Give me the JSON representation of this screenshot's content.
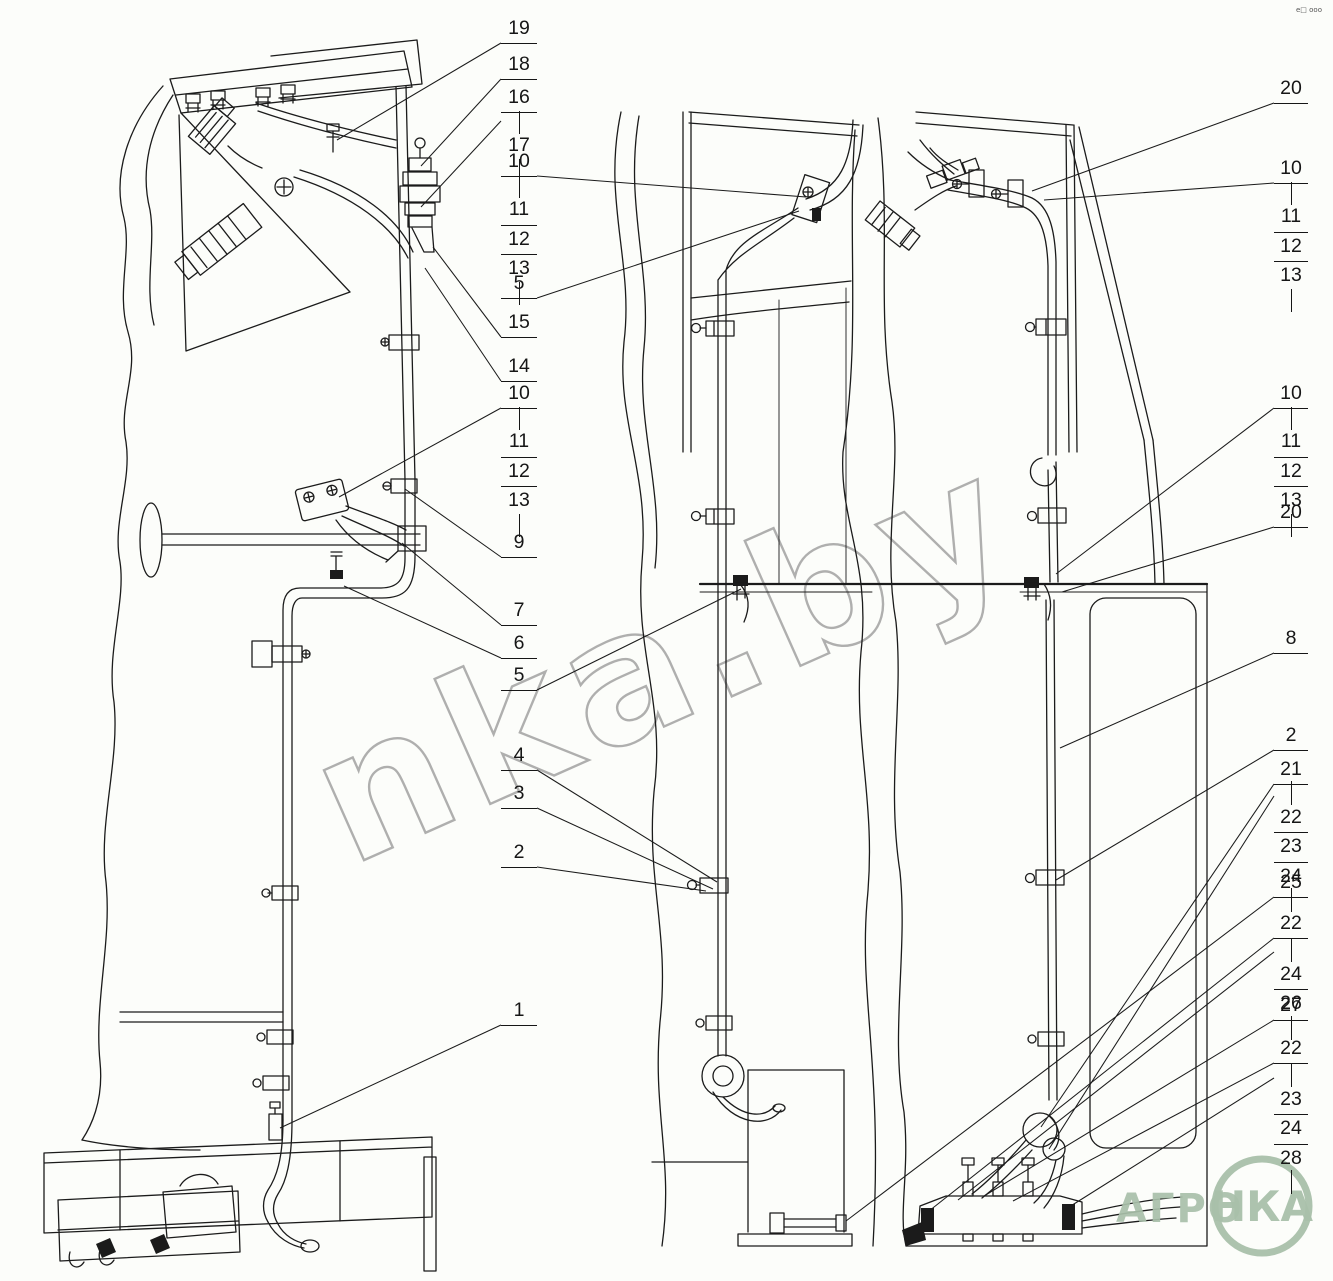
{
  "colors": {
    "line": "#1b1b1b",
    "background": "#fcfdfa",
    "watermark_gray": "#9c9c9c",
    "logo_green": "#a9c0aa"
  },
  "watermark": {
    "text": "nka.by"
  },
  "logo": {
    "prefix": "АГРО",
    "circle_text": "НКА"
  },
  "corner_marks": "e□ ooo",
  "callouts": {
    "left": [
      {
        "label": "19"
      },
      {
        "label": "18"
      },
      {
        "label": "16"
      },
      {
        "label": "17"
      },
      {
        "label": "10",
        "rows": [
          "11",
          "12",
          "13"
        ]
      },
      {
        "label": "5"
      },
      {
        "label": "15"
      },
      {
        "label": "14"
      },
      {
        "label": "10",
        "rows": [
          "11",
          "12",
          "13"
        ]
      },
      {
        "label": "9"
      },
      {
        "label": "7"
      },
      {
        "label": "6"
      },
      {
        "label": "5"
      },
      {
        "label": "4"
      },
      {
        "label": "3"
      },
      {
        "label": "2"
      },
      {
        "label": "1"
      }
    ],
    "right": [
      {
        "label": "20"
      },
      {
        "label": "10",
        "rows": [
          "11",
          "12",
          "13"
        ]
      },
      {
        "label": "10",
        "rows": [
          "11",
          "12",
          "13"
        ]
      },
      {
        "label": "20"
      },
      {
        "label": "8"
      },
      {
        "label": "2"
      },
      {
        "label": "21"
      },
      {
        "rows": [
          "22",
          "23",
          "24"
        ]
      },
      {
        "label": "25"
      },
      {
        "label": "22"
      },
      {
        "rows": [
          "24",
          "26"
        ]
      },
      {
        "label": "27"
      },
      {
        "label": "22"
      },
      {
        "rows": [
          "23",
          "24",
          "28"
        ]
      }
    ]
  }
}
